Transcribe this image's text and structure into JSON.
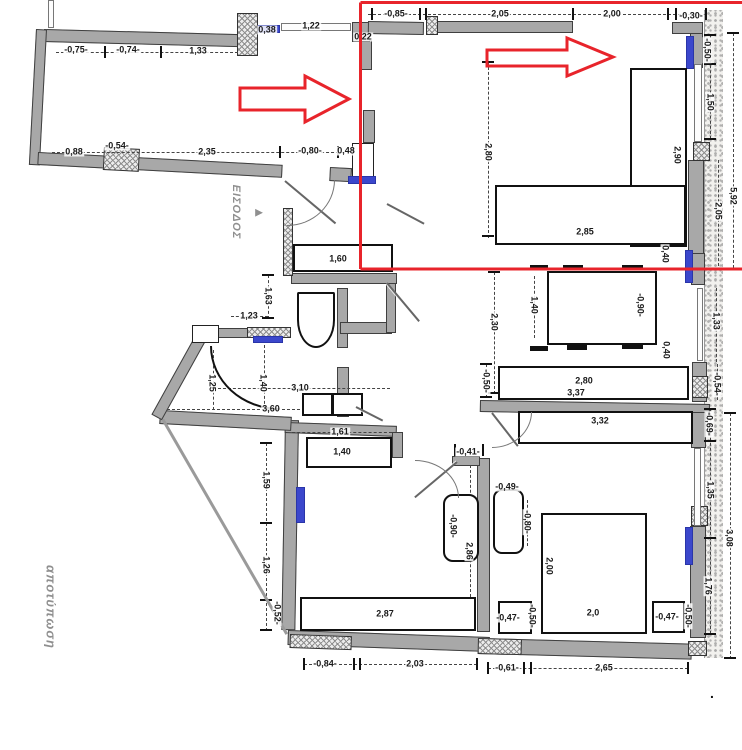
{
  "title": "floor-plan-survey",
  "colors": {
    "wall_gray": "#a8a8a8",
    "window_blue": "#3b47cc",
    "highlight_red": "#e8242b",
    "dim_text": "#191919",
    "greek_text": "#8f8f8f",
    "paper": "#ffffff"
  },
  "texts": {
    "entrance": "ΕΙΣΟΔΟΣ",
    "entrance_arrow": "►",
    "survey": "αποτύπωση",
    "corner_dot": "."
  },
  "overlay": {
    "red_path": "M360.5,269 L742,269 M360.5,2.5 L742,2.5 M360.5,2.5 L360.5,269",
    "arrow1_points": "240,88 305,88 305,76 349,99 305,122 305,110 240,110",
    "arrow2_points": "487,50 567,50 567,38 613,57 567,76 567,66 487,66"
  },
  "dimensions": [
    {
      "t": "-0,75-",
      "x": 76,
      "y": 50,
      "o": "h"
    },
    {
      "t": "-0,74-",
      "x": 128,
      "y": 50,
      "o": "h"
    },
    {
      "t": "1,33",
      "x": 198,
      "y": 51,
      "o": "h"
    },
    {
      "t": "0,38",
      "x": 267,
      "y": 30,
      "o": "h"
    },
    {
      "t": "1,22",
      "x": 311,
      "y": 26,
      "o": "h"
    },
    {
      "t": "0,22",
      "x": 363,
      "y": 37,
      "o": "h"
    },
    {
      "t": "-0,85-",
      "x": 396,
      "y": 14,
      "o": "h"
    },
    {
      "t": "2,05",
      "x": 500,
      "y": 14,
      "o": "h"
    },
    {
      "t": "2,00",
      "x": 612,
      "y": 14,
      "o": "h"
    },
    {
      "t": "-0,30-",
      "x": 691,
      "y": 16,
      "o": "h"
    },
    {
      "t": "0,88",
      "x": 74,
      "y": 152,
      "o": "h"
    },
    {
      "t": "-0,54-",
      "x": 117,
      "y": 146,
      "o": "h"
    },
    {
      "t": "2,35",
      "x": 207,
      "y": 152,
      "o": "h"
    },
    {
      "t": "-0,80-",
      "x": 310,
      "y": 151,
      "o": "h"
    },
    {
      "t": "0,48",
      "x": 346,
      "y": 151,
      "o": "h"
    },
    {
      "t": "1,60",
      "x": 338,
      "y": 259,
      "o": "h"
    },
    {
      "t": "1,23",
      "x": 249,
      "y": 316,
      "o": "h"
    },
    {
      "t": "2,85",
      "x": 585,
      "y": 232,
      "o": "h"
    },
    {
      "t": "3,10",
      "x": 300,
      "y": 388,
      "o": "h"
    },
    {
      "t": "3,60",
      "x": 271,
      "y": 409,
      "o": "h"
    },
    {
      "t": "2,80",
      "x": 584,
      "y": 381,
      "o": "h"
    },
    {
      "t": "3,37",
      "x": 576,
      "y": 393,
      "o": "h"
    },
    {
      "t": "3,32",
      "x": 600,
      "y": 421,
      "o": "h"
    },
    {
      "t": "1,61",
      "x": 340,
      "y": 432,
      "o": "h"
    },
    {
      "t": "1,40",
      "x": 342,
      "y": 452,
      "o": "h"
    },
    {
      "t": "-0,41-",
      "x": 468,
      "y": 452,
      "o": "h"
    },
    {
      "t": "-0,49-",
      "x": 507,
      "y": 487,
      "o": "h"
    },
    {
      "t": "2,87",
      "x": 385,
      "y": 614,
      "o": "h"
    },
    {
      "t": "-0,47-",
      "x": 508,
      "y": 618,
      "o": "h"
    },
    {
      "t": "-0,47-",
      "x": 667,
      "y": 617,
      "o": "h"
    },
    {
      "t": "2,0",
      "x": 593,
      "y": 613,
      "o": "h"
    },
    {
      "t": "-0,84-",
      "x": 325,
      "y": 664,
      "o": "h"
    },
    {
      "t": "2,03",
      "x": 415,
      "y": 664,
      "o": "h"
    },
    {
      "t": "-0,61-",
      "x": 507,
      "y": 668,
      "o": "h"
    },
    {
      "t": "2,65",
      "x": 604,
      "y": 668,
      "o": "h"
    },
    {
      "t": "-0,50-",
      "x": 707,
      "y": 50,
      "o": "v"
    },
    {
      "t": "1,50",
      "x": 710,
      "y": 102,
      "o": "v"
    },
    {
      "t": "2,90",
      "x": 677,
      "y": 155,
      "o": "v"
    },
    {
      "t": "2,80",
      "x": 488,
      "y": 152,
      "o": "v"
    },
    {
      "t": "5,92",
      "x": 733,
      "y": 196,
      "o": "v"
    },
    {
      "t": "2,05",
      "x": 718,
      "y": 211,
      "o": "v"
    },
    {
      "t": "0,40",
      "x": 665,
      "y": 254,
      "o": "v"
    },
    {
      "t": "2,30",
      "x": 494,
      "y": 322,
      "o": "v"
    },
    {
      "t": "1,40",
      "x": 534,
      "y": 305,
      "o": "v"
    },
    {
      "t": "-0,90-",
      "x": 640,
      "y": 305,
      "o": "v"
    },
    {
      "t": "0,40",
      "x": 666,
      "y": 350,
      "o": "v"
    },
    {
      "t": "1,33",
      "x": 716,
      "y": 321,
      "o": "v"
    },
    {
      "t": "-0,54-",
      "x": 717,
      "y": 384,
      "o": "v"
    },
    {
      "t": "-0,50-",
      "x": 486,
      "y": 381,
      "o": "v"
    },
    {
      "t": "1,63",
      "x": 268,
      "y": 296,
      "o": "v"
    },
    {
      "t": "1,25",
      "x": 212,
      "y": 383,
      "o": "v"
    },
    {
      "t": "1,40",
      "x": 263,
      "y": 383,
      "o": "v"
    },
    {
      "t": "-0,69-",
      "x": 709,
      "y": 424,
      "o": "v"
    },
    {
      "t": "1,35",
      "x": 710,
      "y": 490,
      "o": "v"
    },
    {
      "t": "3,08",
      "x": 729,
      "y": 538,
      "o": "v"
    },
    {
      "t": "-0,80-",
      "x": 527,
      "y": 522,
      "o": "v"
    },
    {
      "t": "-0,90-",
      "x": 453,
      "y": 526,
      "o": "v"
    },
    {
      "t": "2,86",
      "x": 469,
      "y": 551,
      "o": "v"
    },
    {
      "t": "1,59",
      "x": 266,
      "y": 480,
      "o": "v"
    },
    {
      "t": "1,26",
      "x": 266,
      "y": 565,
      "o": "v"
    },
    {
      "t": "-0,52-",
      "x": 277,
      "y": 613,
      "o": "v"
    },
    {
      "t": "2,00",
      "x": 549,
      "y": 566,
      "o": "v"
    },
    {
      "t": "-0,50-",
      "x": 532,
      "y": 616,
      "o": "v"
    },
    {
      "t": "-0,50-",
      "x": 688,
      "y": 616,
      "o": "v"
    },
    {
      "t": "1,76",
      "x": 708,
      "y": 586,
      "o": "v"
    }
  ],
  "plan": {
    "insulation": [
      [
        704,
        10,
        18,
        648
      ]
    ],
    "walls": [
      [
        44,
        29,
        196,
        13,
        1.5
      ],
      [
        36,
        29,
        11,
        136,
        3
      ],
      [
        38,
        152,
        245,
        13,
        3
      ],
      [
        330,
        167,
        22,
        14,
        3
      ],
      [
        363,
        110,
        12,
        33,
        0
      ],
      [
        360,
        40,
        12,
        30,
        0
      ],
      [
        352,
        22,
        18,
        20,
        0
      ],
      [
        368,
        21,
        56,
        13,
        1
      ],
      [
        437,
        21,
        136,
        12,
        0
      ],
      [
        672,
        22,
        31,
        12,
        0
      ],
      [
        690,
        33,
        13,
        35,
        0
      ],
      [
        688,
        160,
        16,
        108,
        0
      ],
      [
        691,
        253,
        14,
        32,
        0
      ],
      [
        692,
        362,
        15,
        40,
        0
      ],
      [
        480,
        400,
        230,
        12,
        1
      ],
      [
        691,
        412,
        15,
        36,
        0
      ],
      [
        690,
        526,
        16,
        112,
        0
      ],
      [
        285,
        420,
        14,
        210,
        1
      ],
      [
        288,
        630,
        202,
        15,
        2
      ],
      [
        478,
        638,
        214,
        16,
        1.5
      ],
      [
        477,
        458,
        13,
        174,
        0
      ],
      [
        452,
        456,
        28,
        10,
        0
      ],
      [
        285,
        422,
        112,
        11,
        2
      ],
      [
        392,
        432,
        11,
        26,
        0
      ],
      [
        217,
        328,
        74,
        10,
        0
      ],
      [
        337,
        288,
        11,
        60,
        0
      ],
      [
        340,
        322,
        52,
        12,
        0
      ],
      [
        386,
        283,
        10,
        50,
        0
      ],
      [
        337,
        367,
        12,
        50,
        0
      ],
      [
        291,
        273,
        106,
        11,
        0
      ],
      [
        160,
        410,
        132,
        14,
        3
      ],
      [
        196,
        334,
        12,
        92,
        29
      ]
    ],
    "piers_hatched": [
      [
        237,
        13,
        21,
        43,
        0
      ],
      [
        426,
        16,
        12,
        19,
        0
      ],
      [
        104,
        147,
        36,
        23,
        3
      ],
      [
        693,
        142,
        17,
        19,
        0
      ],
      [
        692,
        376,
        16,
        22,
        0
      ],
      [
        290,
        634,
        62,
        14,
        2
      ],
      [
        478,
        638,
        44,
        16,
        1.5
      ],
      [
        688,
        641,
        19,
        15,
        0
      ],
      [
        247,
        327,
        44,
        11,
        0
      ],
      [
        283,
        208,
        10,
        68,
        0
      ],
      [
        691,
        506,
        17,
        20,
        0
      ]
    ],
    "piers_white": [
      [
        352,
        143,
        22,
        34
      ],
      [
        192,
        325,
        27,
        18
      ]
    ],
    "windows_blue": [
      [
        258,
        25,
        22,
        8
      ],
      [
        348,
        176,
        28,
        8
      ],
      [
        253,
        336,
        30,
        7
      ],
      [
        686,
        36,
        8,
        33
      ],
      [
        685,
        250,
        8,
        33
      ],
      [
        296,
        487,
        9,
        36
      ],
      [
        685,
        527,
        8,
        38
      ]
    ],
    "windows_thin": [
      [
        281,
        23,
        70,
        8
      ],
      [
        694,
        64,
        8,
        78
      ],
      [
        697,
        288,
        6,
        73
      ],
      [
        694,
        448,
        7,
        78
      ],
      [
        48,
        0,
        6,
        28
      ]
    ],
    "furniture": [
      [
        630,
        68,
        57,
        179
      ],
      [
        495,
        185,
        191,
        60
      ],
      [
        547,
        271,
        110,
        74
      ],
      [
        498,
        366,
        191,
        34
      ],
      [
        518,
        411,
        175,
        33
      ],
      [
        541,
        513,
        106,
        121
      ],
      [
        498,
        601,
        34,
        33
      ],
      [
        652,
        601,
        33,
        32
      ],
      [
        300,
        597,
        176,
        34
      ],
      [
        306,
        437,
        86,
        31
      ],
      [
        293,
        244,
        100,
        28
      ],
      [
        302,
        393,
        31,
        23
      ],
      [
        332,
        393,
        31,
        23
      ]
    ],
    "furniture_round": [
      [
        443,
        494,
        36,
        68,
        10
      ],
      [
        493,
        489,
        31,
        65,
        9
      ]
    ],
    "toilet": [
      297,
      292,
      38,
      56
    ],
    "chair_ticks": [
      [
        530,
        265,
        18,
        5
      ],
      [
        563,
        265,
        20,
        5
      ],
      [
        622,
        265,
        21,
        5
      ],
      [
        567,
        345,
        20,
        5
      ],
      [
        622,
        344,
        21,
        5
      ],
      [
        530,
        346,
        18,
        5
      ]
    ],
    "dim_lines": [
      [
        56,
        52,
        182,
        "h"
      ],
      [
        52,
        152,
        292,
        "h"
      ],
      [
        368,
        14,
        338,
        "h"
      ],
      [
        502,
        231,
        180,
        "h"
      ],
      [
        510,
        381,
        160,
        "h"
      ],
      [
        505,
        393,
        170,
        "h"
      ],
      [
        522,
        421,
        164,
        "h"
      ],
      [
        231,
        316,
        37,
        "h"
      ],
      [
        218,
        388,
        172,
        "h"
      ],
      [
        167,
        409,
        188,
        "h"
      ],
      [
        292,
        432,
        100,
        "h"
      ],
      [
        315,
        452,
        70,
        "h"
      ],
      [
        556,
        613,
        80,
        "h"
      ],
      [
        305,
        614,
        162,
        "h"
      ],
      [
        304,
        664,
        173,
        "h"
      ],
      [
        488,
        668,
        200,
        "h"
      ],
      [
        302,
        405,
        60,
        "h"
      ],
      [
        488,
        62,
        176,
        "v"
      ],
      [
        677,
        72,
        162,
        "v"
      ],
      [
        733,
        33,
        235,
        "v"
      ],
      [
        710,
        35,
        104,
        "v"
      ],
      [
        718,
        160,
        106,
        "v"
      ],
      [
        716,
        288,
        74,
        "v"
      ],
      [
        717,
        364,
        36,
        "v"
      ],
      [
        494,
        272,
        122,
        "v"
      ],
      [
        534,
        276,
        62,
        "v"
      ],
      [
        640,
        276,
        62,
        "v"
      ],
      [
        486,
        364,
        34,
        "v"
      ],
      [
        268,
        275,
        44,
        "v"
      ],
      [
        213,
        350,
        60,
        "v"
      ],
      [
        264,
        345,
        64,
        "v"
      ],
      [
        266,
        443,
        188,
        "v"
      ],
      [
        470,
        465,
        132,
        "v"
      ],
      [
        453,
        500,
        55,
        "v"
      ],
      [
        527,
        500,
        46,
        "v"
      ],
      [
        549,
        518,
        84,
        "v"
      ],
      [
        730,
        413,
        246,
        "v"
      ],
      [
        710,
        408,
        226,
        "v"
      ]
    ],
    "ticks": [
      [
        372,
        14,
        "h"
      ],
      [
        420,
        14,
        "h"
      ],
      [
        426,
        14,
        "h"
      ],
      [
        573,
        14,
        "h"
      ],
      [
        668,
        14,
        "h"
      ],
      [
        676,
        14,
        "h"
      ],
      [
        706,
        14,
        "h"
      ],
      [
        105,
        52,
        "h"
      ],
      [
        161,
        52,
        "h"
      ],
      [
        280,
        152,
        "h"
      ],
      [
        338,
        152,
        "h"
      ],
      [
        304,
        664,
        "h"
      ],
      [
        354,
        664,
        "h"
      ],
      [
        360,
        664,
        "h"
      ],
      [
        477,
        664,
        "h"
      ],
      [
        488,
        668,
        "h"
      ],
      [
        524,
        668,
        "h"
      ],
      [
        531,
        668,
        "h"
      ],
      [
        688,
        668,
        "h"
      ],
      [
        502,
        232,
        "h"
      ],
      [
        680,
        232,
        "h"
      ],
      [
        455,
        450,
        "h"
      ],
      [
        483,
        450,
        "h"
      ],
      [
        710,
        409,
        "v"
      ],
      [
        710,
        441,
        "v"
      ],
      [
        710,
        538,
        "v"
      ],
      [
        710,
        634,
        "v"
      ],
      [
        710,
        35,
        "v"
      ],
      [
        710,
        64,
        "v"
      ],
      [
        710,
        139,
        "v"
      ],
      [
        733,
        33,
        "v"
      ],
      [
        488,
        62,
        "v"
      ],
      [
        488,
        236,
        "v"
      ],
      [
        494,
        272,
        "v"
      ],
      [
        494,
        393,
        "v"
      ],
      [
        486,
        364,
        "v"
      ],
      [
        486,
        397,
        "v"
      ],
      [
        268,
        275,
        "v"
      ],
      [
        268,
        318,
        "v"
      ],
      [
        266,
        443,
        "v"
      ],
      [
        266,
        523,
        "v"
      ],
      [
        266,
        600,
        "v"
      ],
      [
        266,
        630,
        "v"
      ],
      [
        730,
        413,
        "v"
      ],
      [
        730,
        658,
        "v"
      ]
    ],
    "door_leaves": [
      [
        285,
        180,
        66,
        40
      ],
      [
        387,
        203,
        42,
        28
      ],
      [
        387,
        282,
        50,
        50
      ],
      [
        356,
        406,
        30,
        27
      ],
      [
        457,
        461,
        55,
        140
      ],
      [
        492,
        412,
        42,
        52
      ]
    ],
    "arcs": [
      [
        210,
        346,
        70,
        64,
        "bl",
        2
      ],
      [
        287,
        180,
        48,
        46,
        "br",
        1
      ],
      [
        492,
        412,
        40,
        36,
        "br",
        1
      ],
      [
        415,
        460,
        44,
        38,
        "tr",
        1
      ]
    ],
    "slants": [
      [
        163,
        418,
        248,
        60
      ]
    ]
  },
  "positions": {
    "entrance_text": {
      "x": 236,
      "y": 212
    },
    "entrance_arrow": {
      "x": 259,
      "y": 212
    },
    "survey_text": {
      "x": 51,
      "y": 607
    },
    "corner_dot": {
      "x": 710,
      "y": 685
    }
  }
}
